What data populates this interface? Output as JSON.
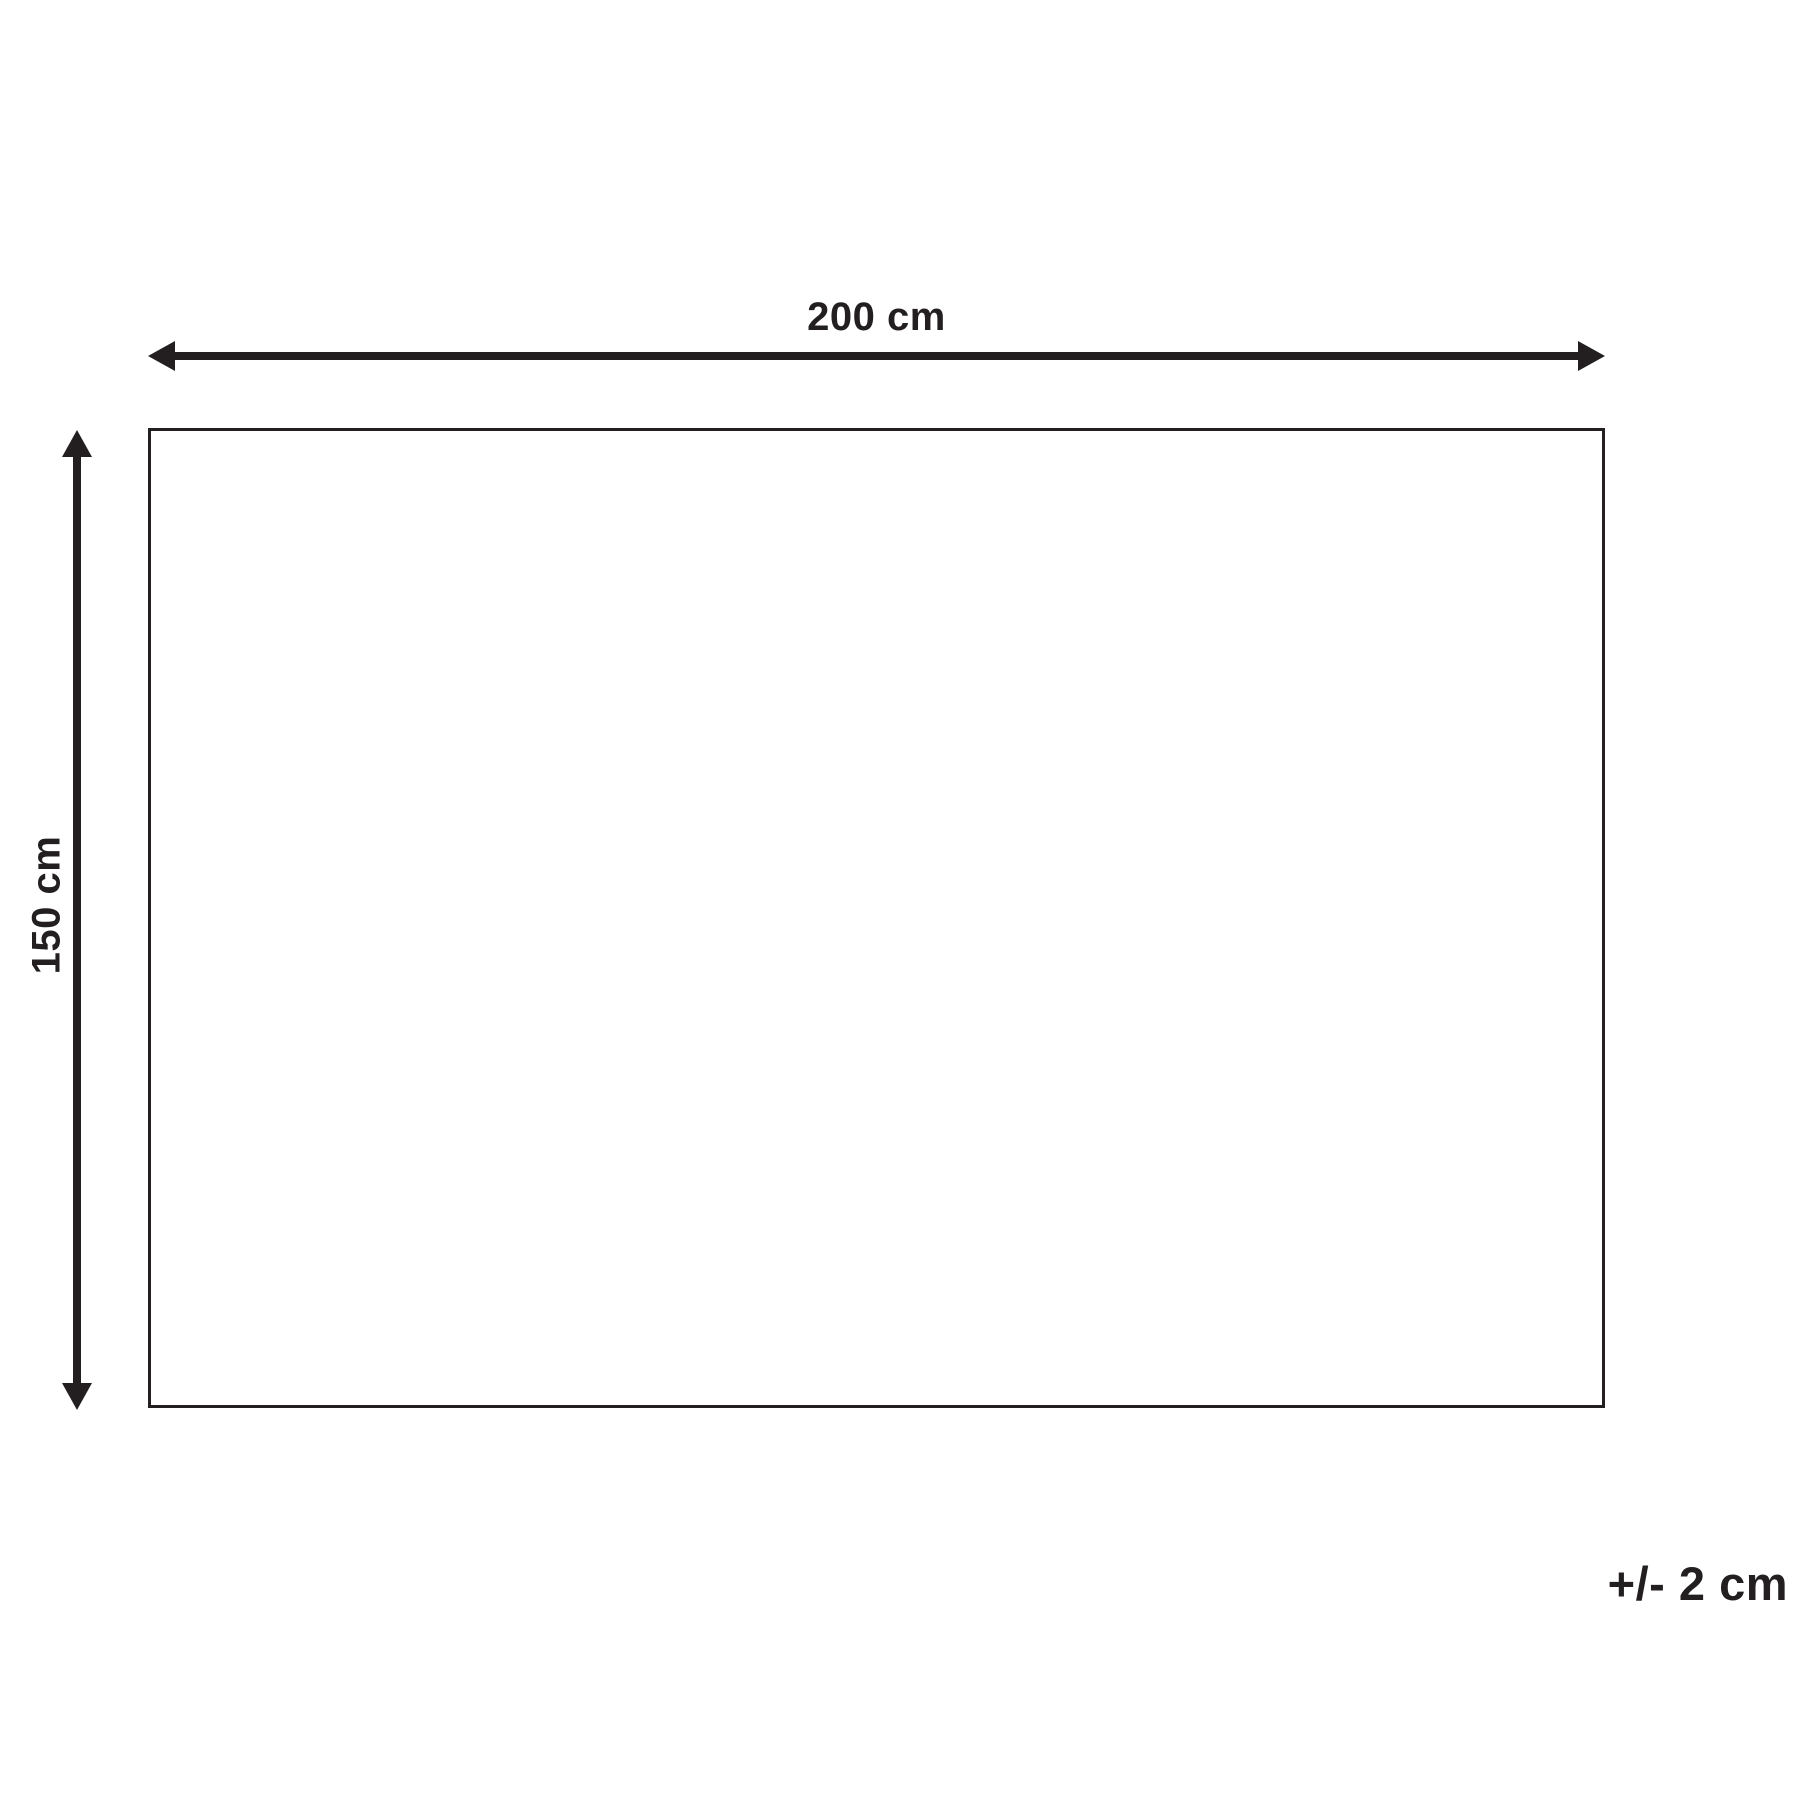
{
  "colors": {
    "ink": "#231f20",
    "background": "#ffffff"
  },
  "diagram": {
    "type": "product-dimension-diagram",
    "width": {
      "label": "200 cm"
    },
    "height": {
      "label": "150 cm"
    },
    "tolerance": {
      "label": "+/- 2 cm"
    }
  }
}
